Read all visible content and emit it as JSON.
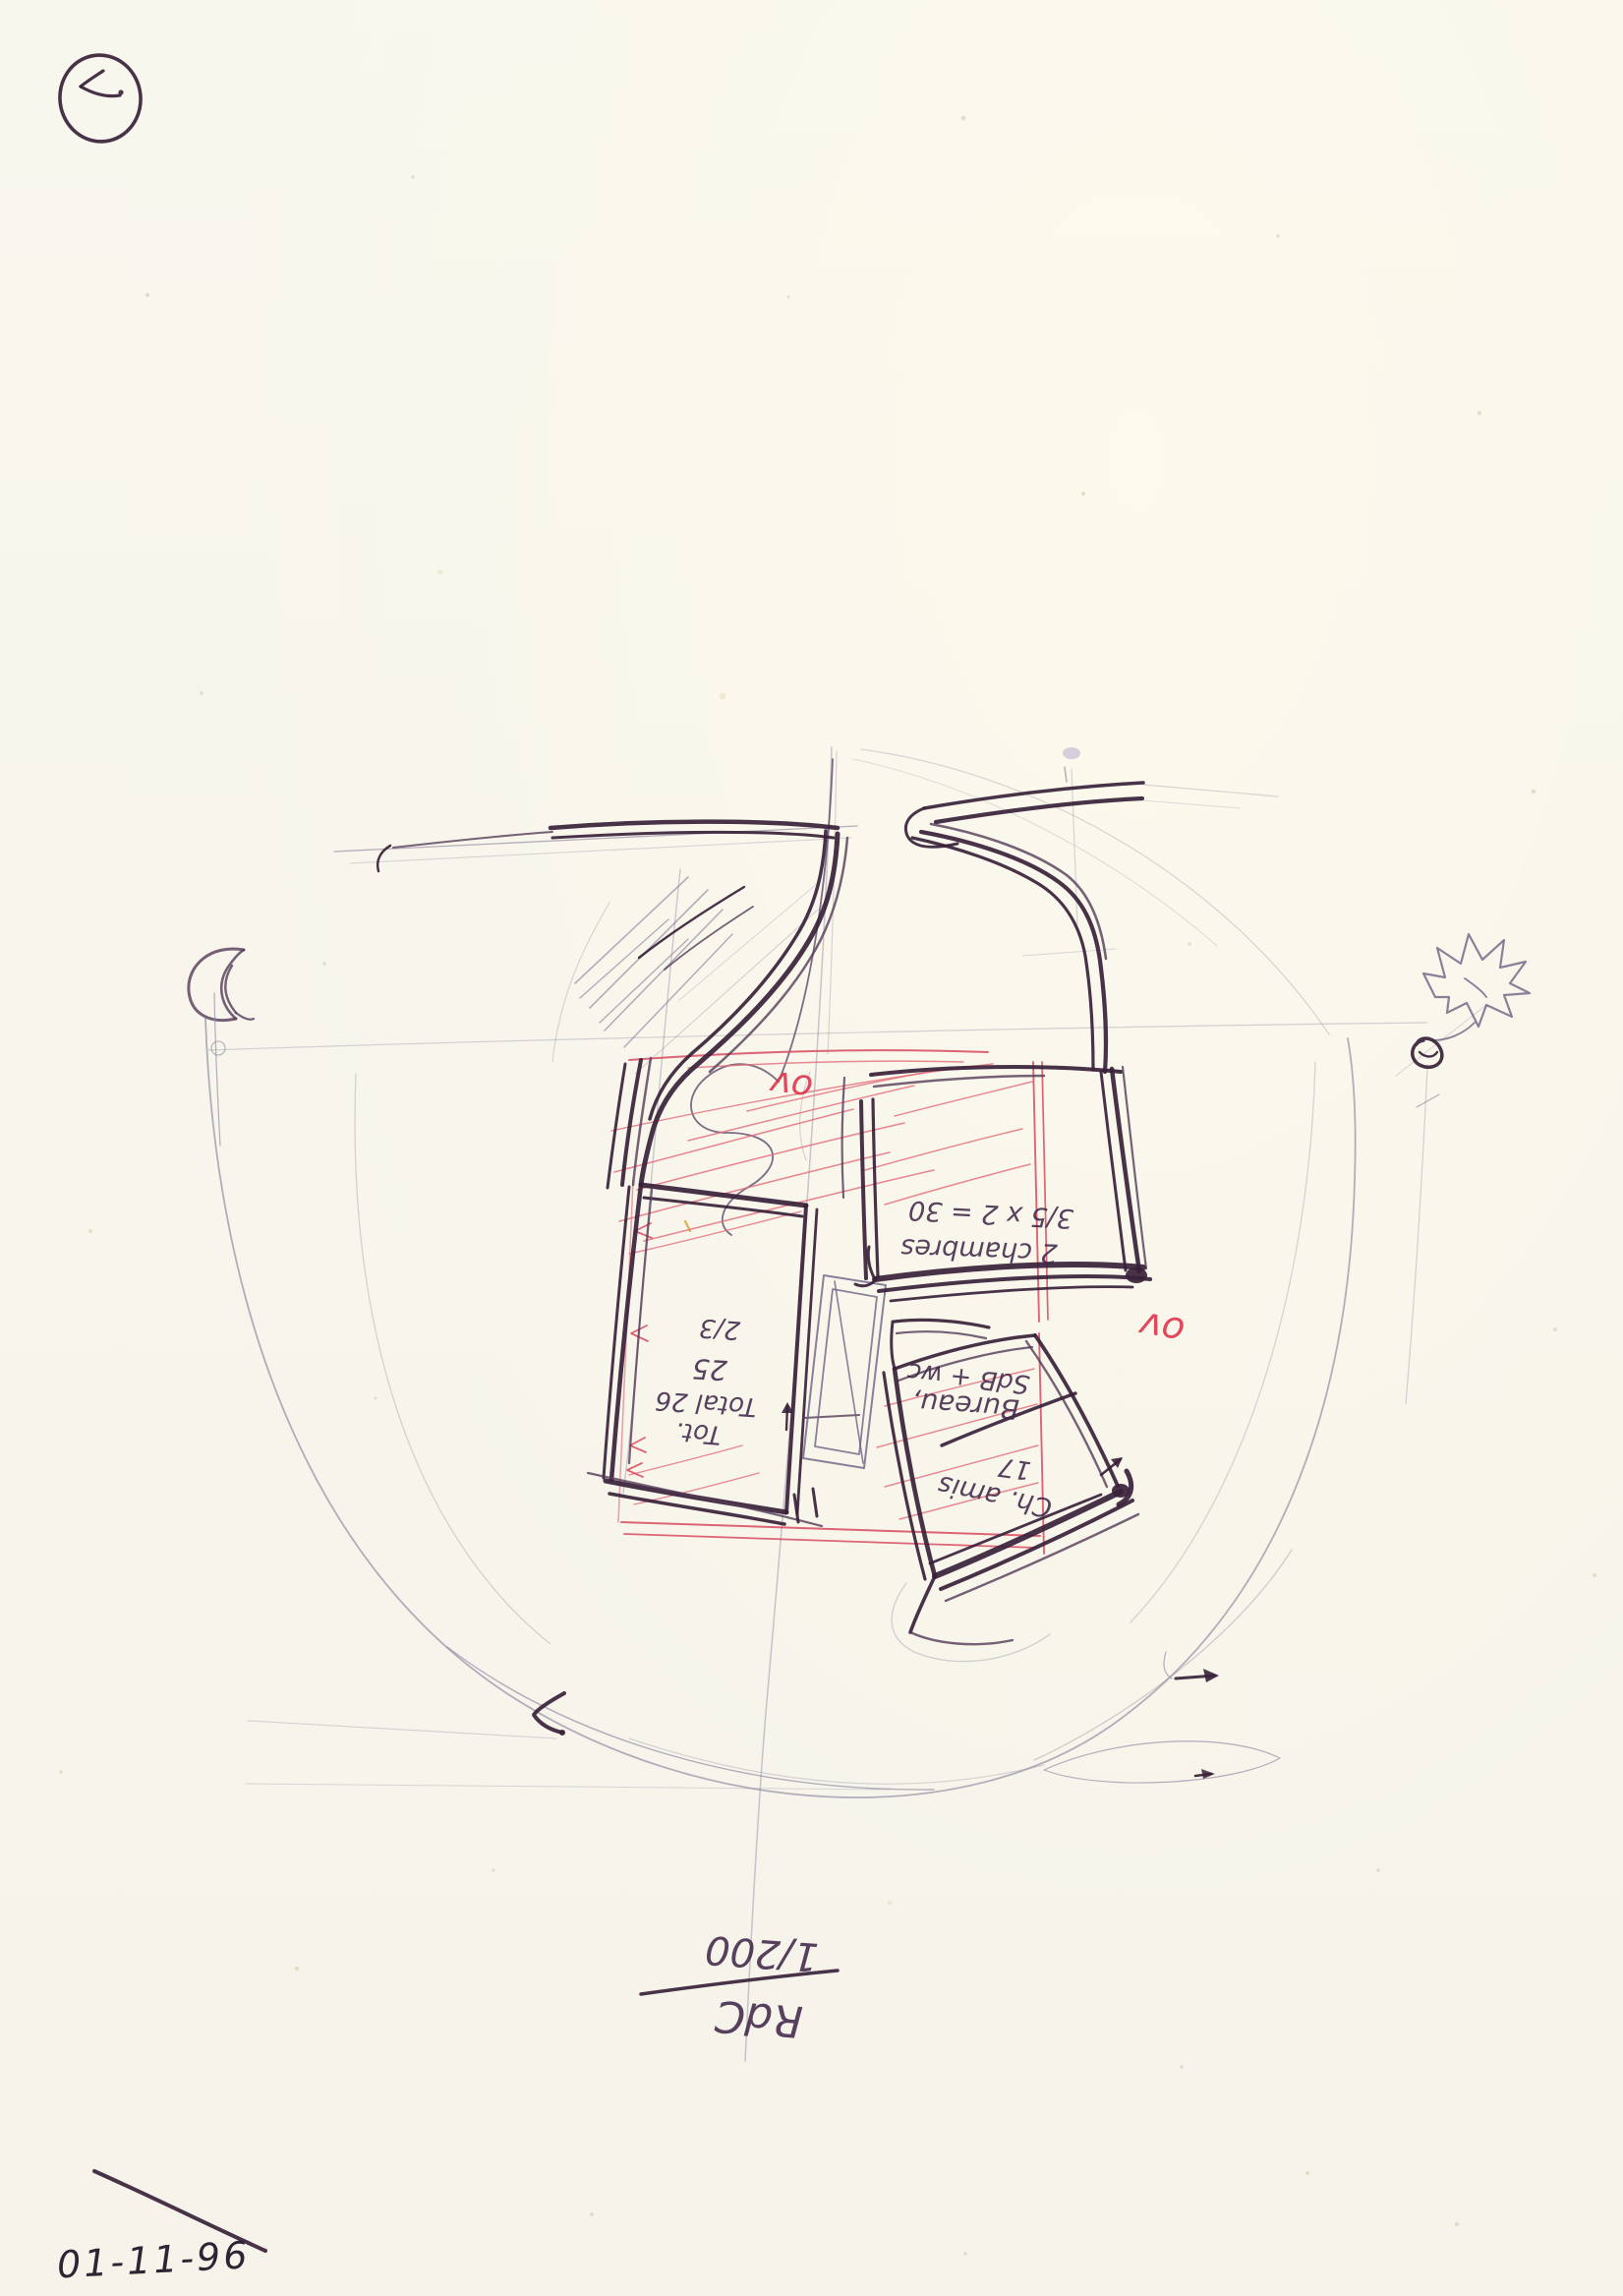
{
  "annotations": {
    "red_note_upper": "ov",
    "red_note_right": "ov",
    "block_upper_right": {
      "line1": "3/5 x 2 = 30",
      "line2": "2 chambres"
    },
    "block_left": {
      "line1": "2/3",
      "line2": "25",
      "line3": "Total 26",
      "line4": "Tot."
    },
    "block_lower_right": {
      "line1": "SdB + wc",
      "line2": "Bureau,",
      "line3": "17",
      "line4": "Ch. amis"
    },
    "scale_note": {
      "numerator": "1/200",
      "denominator": "RdC"
    },
    "date": "01-11-96"
  },
  "colors": {
    "ink": "#38213a",
    "pencil": "#8d86a0",
    "red_marker": "#d84a5f",
    "paper": "#f8f7ee"
  }
}
